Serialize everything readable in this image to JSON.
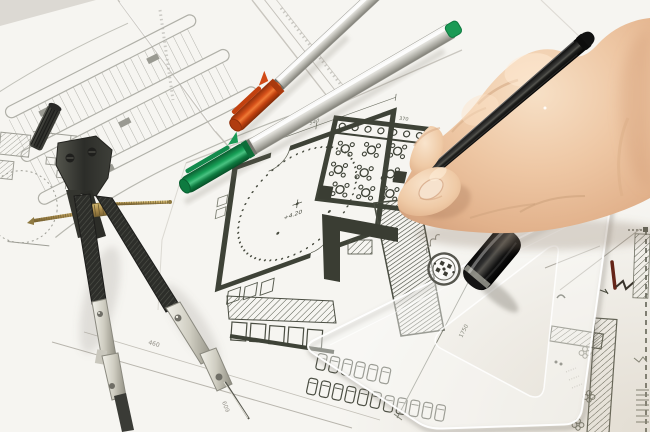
{
  "scene": {
    "description": "Photograph: architect's desk, right hand drawing with a black pen over overlapping floor-plan blueprints, with a drafting compass, orange and green capped markers, a black pen cap and a transparent set-square ruler",
    "objects": {
      "hand": "right-hand-holding-pen",
      "drawing_pen": {
        "name": "black-fineliner-pen",
        "color": "#141414"
      },
      "pen_cap": {
        "name": "black-pen-cap",
        "color": "#111111"
      },
      "compass": {
        "name": "drafting-compass",
        "body_color": "#2e2f2b",
        "metal_color": "#cfcdc1",
        "rod_color": "#b5965a"
      },
      "marker_orange": {
        "name": "orange-capped-marker",
        "cap_color": "#d14a16",
        "barrel_color": "#d9d8d2"
      },
      "marker_green": {
        "name": "green-capped-marker",
        "cap_color": "#17a057",
        "barrel_color": "#d9d8d2"
      },
      "ruler": {
        "name": "transparent-set-square",
        "stamp": "circular-stamp-logo"
      },
      "drawings": "architectural-floor-plans"
    },
    "colors": {
      "paper": "#f8f7f4",
      "ink": "#3e4237",
      "light_ink": "#a0a099",
      "skin": "#eec7a4",
      "shadow": "#c9c6c0"
    }
  },
  "plan_annotations": {
    "elevation": "+4.20",
    "dim_top": "540",
    "dim_room": "370",
    "dim_a": "460",
    "dim_b": "609",
    "dim_c": "1750",
    "dim_d": "1254",
    "left_label": "12.04"
  }
}
